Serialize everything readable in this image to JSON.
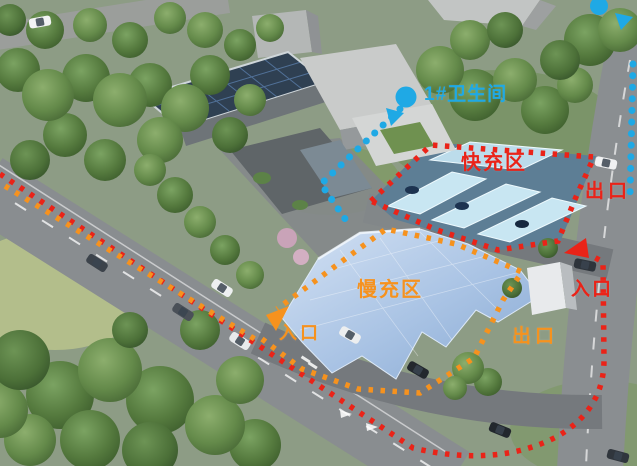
{
  "annotations": {
    "fast_zone": {
      "label": "快充区",
      "exit": "出口",
      "entrance": "入口",
      "route_color": "#ea2318"
    },
    "slow_zone": {
      "label": "慢充区",
      "exit": "出口",
      "entrance": "入口",
      "route_color": "#f6921e"
    },
    "restroom": {
      "label": "1#卫生间",
      "marker_color": "#1fa9e5"
    }
  },
  "icons": {
    "location_dot": "●",
    "direction_arrow": "▼"
  }
}
